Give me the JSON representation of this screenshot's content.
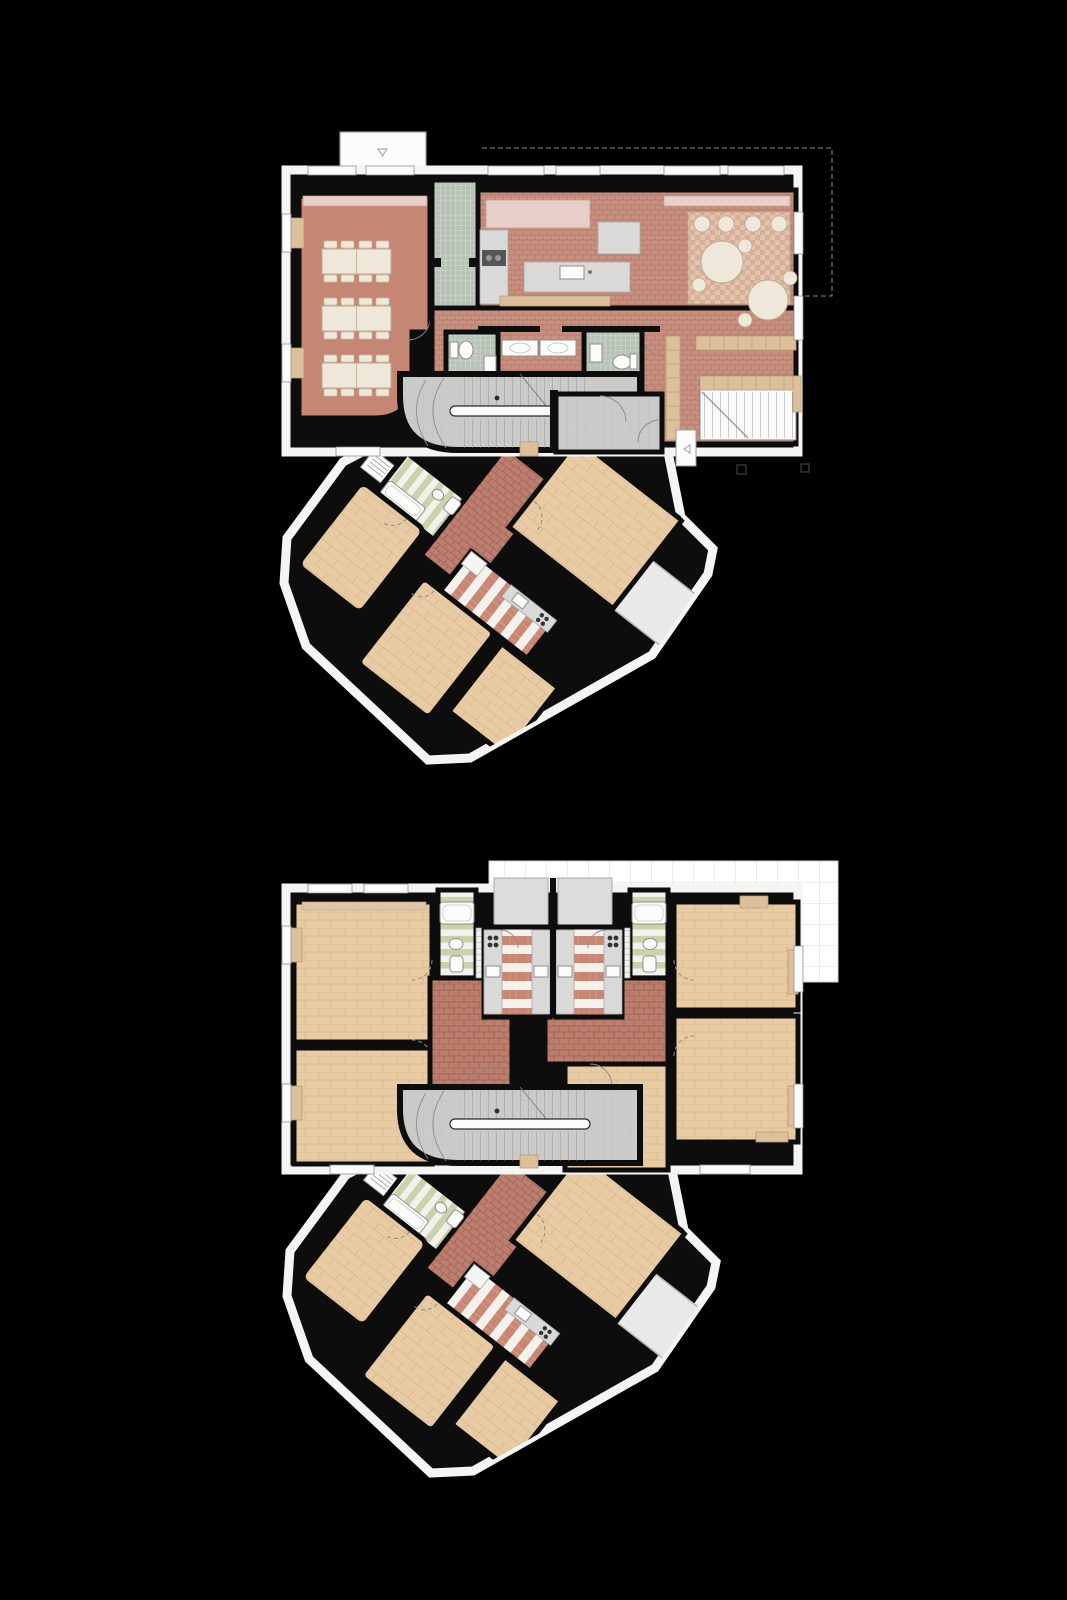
{
  "figure": {
    "type": "architectural-floor-plans",
    "background": "#000000",
    "plans": [
      {
        "id": "plan-upper",
        "label": "Upper floor plan — communal level with dining room, kitchen, living room, WCs, stair core and angled bedroom wing"
      },
      {
        "id": "plan-lower",
        "label": "Lower floor plan — two mirrored flats with galley kitchens, bathrooms, four rooms, roof terrace, stair core and angled bedroom wing"
      }
    ]
  },
  "palette": {
    "bg": "#000000",
    "wall": "#0d0d0d",
    "outline": "#f4f4f3",
    "terracotta": "#c58673",
    "brick": "#bd7e6d",
    "brick_grout": "#a2695d",
    "brick_light": "#c9907f",
    "brick_light_grout": "#b17c6c",
    "wood": "#e8cba3",
    "wood_line": "#d7b68c",
    "green_tile": "#b7c3b6",
    "green_tile_line": "#e7ebe6",
    "green_stripe": "#cbd1aa",
    "red_stripe": "#c98672",
    "stripe_bg": "#f3f1ec",
    "gray_floor": "#cbcbc9",
    "gray_floor_line": "#bbbbb9",
    "gray_light": "#dcdcda",
    "gray_counter": "#d9d9d8",
    "cream": "#efe8da",
    "tan": "#dcc09c",
    "pink_sill": "#e9cfc9",
    "rug_a": "#e3c4ac",
    "rug_b": "#d5af97",
    "rug_line": "#c7a68e",
    "hatch_line": "#dadad8",
    "fixture_stroke": "#8f8f8d",
    "arc": "#8b8b8b",
    "tread": "#8e8e8c",
    "white": "#fbfbfa",
    "appliance": "#555555",
    "marker": "#3f3f3f"
  }
}
